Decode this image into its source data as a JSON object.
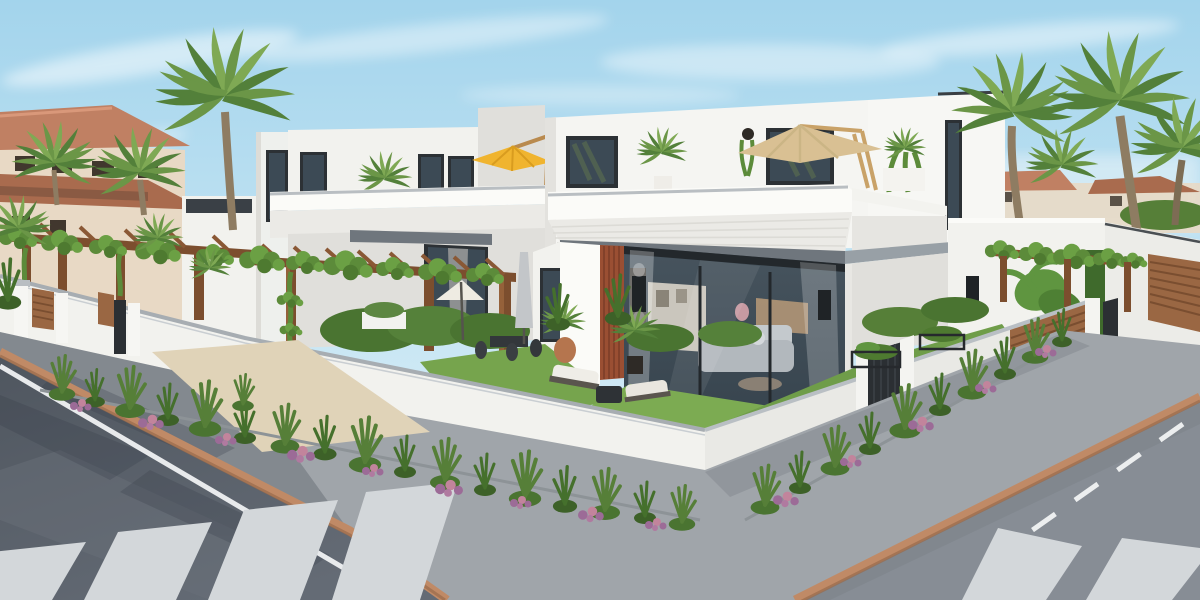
{
  "meta": {
    "title": "New-build modern white villas – street corner exterior render",
    "domain": "architectural visualization",
    "dimensions": "1200×600"
  },
  "scene": {
    "description": "Photorealistic daytime render of a corner plot with two-storey flat-roofed white villas, roof terraces with cantilever parasols, timber pergolas covered in climbing vines, landscaped gardens behind a low white boundary wall, palm trees, and an asphalt street junction with zebra crossings.",
    "sky": "clear pale blue sky with thin wispy clouds",
    "lighting": "bright sunlight from the upper left",
    "foreground": "asphalt roads meeting at a corner: white lane lines, terracotta kerbs, grey paved sidewalk, two pedestrian crossings, planting beds of shrubs with pink and purple flowers",
    "midground": "white rendered boundary wall with grey coping, anthracite metal gates, timber slat panels and black wire planters",
    "background": "modern white villas with dark aluminium windows and glazed living rooms; older terracotta-roofed apartment building at far left; fan palm cluster at right"
  },
  "objects": {
    "old_building": "terracotta-roofed apartment block",
    "left_villas": "row of white villas with entrance pergolas and timber gates",
    "middle_villa": "two-storey villa with yellow cantilever parasol on its roof terrace",
    "main_villa": "corner villa with tan cantilever parasol, roof-terrace plants, glazed living room with grey sofa and black wall sconces",
    "right_buildings": "neighbouring white villa volumes with timber slat garage door",
    "palms": "large fan palm at left, small palms by the old building, palm cluster at right",
    "pergolas": "brown timber pergolas with green climbing vines",
    "garden": "artificial lawn, clipped hedges, outdoor dining set under a white parasol, two sun loungers with side table, potted palms, closed grey parasol",
    "boundary_wall": "white rendered wall with grey coping, pillars, gates and planters",
    "street": "dark asphalt left road and lighter right road with zebra crossings, kerbs, lane markings and tree shadows"
  },
  "colors": {
    "sky_top": "#a3d4ec",
    "sky_mid": "#c8e6f4",
    "sky_low": "#e4f2f9",
    "cloud": "#ffffff",
    "wall_white": "#f2f2ee",
    "wall_bright": "#fbfbf8",
    "wall_shade": "#e0dfdb",
    "cladding": "#ebeae6",
    "fascia_dark": "#6f767d",
    "fascia_light": "#98a0a6",
    "coping": "#a7adb2",
    "window_frame": "#2c3135",
    "glass_dark": "#3c4a55",
    "glass_light": "#687a87",
    "old_wall": "#e8d9c5",
    "roof_tile": "#c08063",
    "roof_tile_dark": "#a96b4e",
    "palm_light": "#7fa954",
    "palm_mid": "#6b9647",
    "palm_dark": "#53803a",
    "trunk": "#8e7c62",
    "pergola_wood": "#7c4e2e",
    "pergola_wood_light": "#95613a",
    "slat_wood": "#9a6743",
    "rust_slats": "#9a4f33",
    "vine_green": "#5c8b3a",
    "grass": "#76a44d",
    "grass_bright": "#82b058",
    "hedge": "#4a7431",
    "shrub": "#567f38",
    "flower_purple": "#9c6b97",
    "flower_pink": "#c2849c",
    "asphalt_left": "#5b626c",
    "asphalt_right": "#878d95",
    "sidewalk": "#a0a5aa",
    "apron_beige": "#e0d3b8",
    "kerb_terracotta": "#c08a66",
    "road_line": "#e8eaec",
    "crossing_stripe": "#d3d7da",
    "umbrella_yellow": "#f0b42f",
    "umbrella_tan": "#d9c093",
    "umbrella_white": "#eeebe2",
    "closed_parasol": "#c3c6c9",
    "metal_gate": "#2b2f33",
    "sconce": "#1f2326",
    "planter_black": "#26292d",
    "pot_terracotta": "#b5754e"
  }
}
